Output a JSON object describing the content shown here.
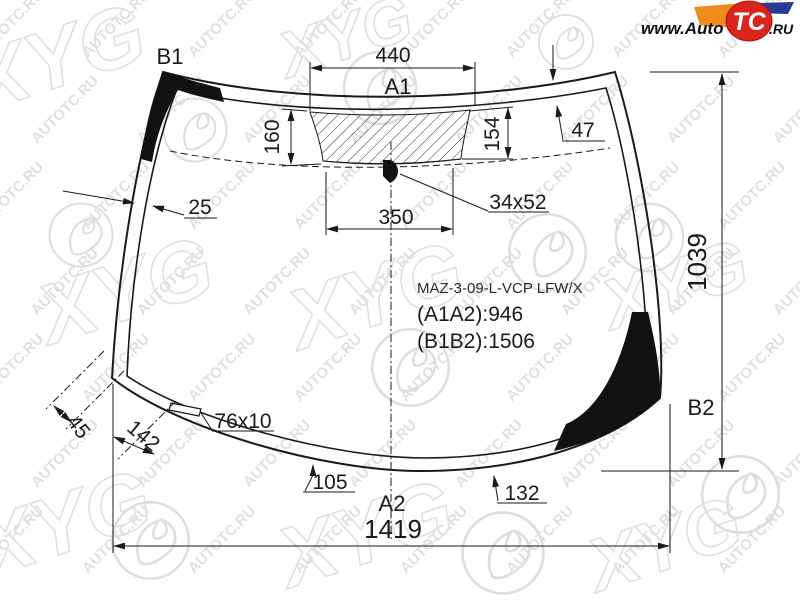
{
  "logo": {
    "www": "www.Auto",
    "tc": "TC",
    "ru": ".RU"
  },
  "watermark": {
    "text": "AUTOTC.RU",
    "xyg": "XYG"
  },
  "part": {
    "code": "MAZ-3-09-L-VCP LFW/X",
    "a1a2": "(A1A2):946",
    "b1b2": "(B1B2):1506"
  },
  "glass_labels": {
    "a1": "A1",
    "a2": "A2",
    "b1": "B1",
    "b2": "B2"
  },
  "dims": {
    "top_band_width": "440",
    "band_height_left": "160",
    "band_height_right": "154",
    "top_right_band": "47",
    "left_band": "25",
    "mirror_band_width": "350",
    "mirror_mount_size": "34x52",
    "wiper_heater": "76x10",
    "edge_offset_small": "45",
    "edge_offset_large": "142",
    "bottom_offset_left": "105",
    "bottom_offset_right": "132",
    "total_width": "1419",
    "total_height": "1039"
  },
  "colors": {
    "line": "#1a1a1a",
    "watermark": "#cccccc",
    "logo_red": "#da251c",
    "logo_orange": "#f08c1e",
    "logo_blue": "#2b3990"
  }
}
